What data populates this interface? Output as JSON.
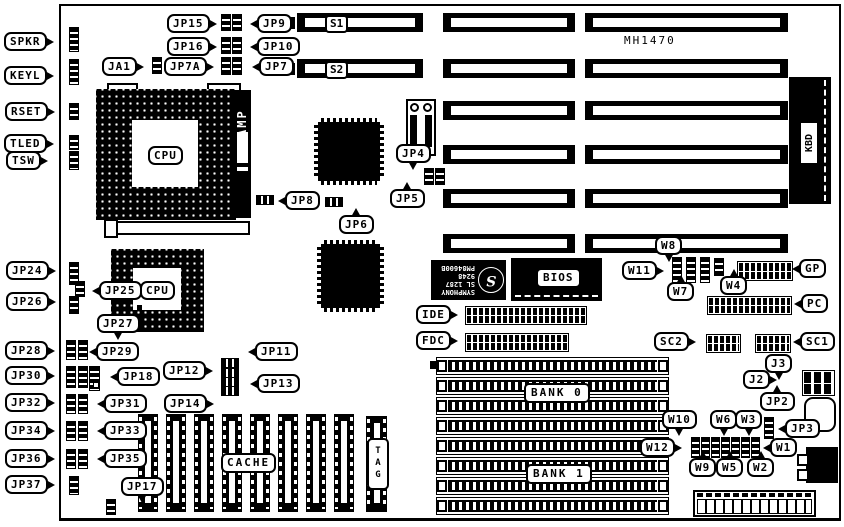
{
  "board": {
    "model": "MH1470"
  },
  "labels": {
    "spkr": "SPKR",
    "keyl": "KEYL",
    "rset": "RSET",
    "tled": "TLED",
    "tsw": "TSW",
    "jp15": "JP15",
    "jp16": "JP16",
    "ja1": "JA1",
    "jp7a": "JP7A",
    "jp9": "JP9",
    "jp10": "JP10",
    "jp7": "JP7",
    "s1": "S1",
    "s2": "S2",
    "jp4": "JP4",
    "jp5": "JP5",
    "jp6": "JP6",
    "jp8": "JP8",
    "jp24": "JP24",
    "jp25": "JP25",
    "jp26": "JP26",
    "jp27": "JP27",
    "jp28": "JP28",
    "jp29": "JP29",
    "jp30": "JP30",
    "jp31": "JP31",
    "jp32": "JP32",
    "jp33": "JP33",
    "jp34": "JP34",
    "jp35": "JP35",
    "jp36": "JP36",
    "jp37": "JP37",
    "jp11": "JP11",
    "jp12": "JP12",
    "jp13": "JP13",
    "jp14": "JP14",
    "jp17": "JP17",
    "jp18": "JP18",
    "cpu1": "CPU",
    "cpu2": "CPU",
    "amp": "AMP",
    "kbd": "KBD",
    "bios": "BIOS",
    "cache": "CACHE",
    "tag": "TAG",
    "bank0": "BANK 0",
    "bank1": "BANK 1",
    "ide": "IDE",
    "fdc": "FDC",
    "gp": "GP",
    "pc": "PC",
    "sc1": "SC1",
    "sc2": "SC2",
    "j2": "J2",
    "j3": "J3",
    "jp2": "JP2",
    "jp3": "JP3",
    "w1": "W1",
    "w2": "W2",
    "w3": "W3",
    "w4": "W4",
    "w5": "W5",
    "w6": "W6",
    "w7": "W7",
    "w8": "W8",
    "w9": "W9",
    "w10": "W10",
    "w11": "W11",
    "w12": "W12"
  },
  "chipset": {
    "brand": "SYMPHONY",
    "line2": "SL 1287",
    "line3": "9248",
    "line4": "PM84600B"
  }
}
